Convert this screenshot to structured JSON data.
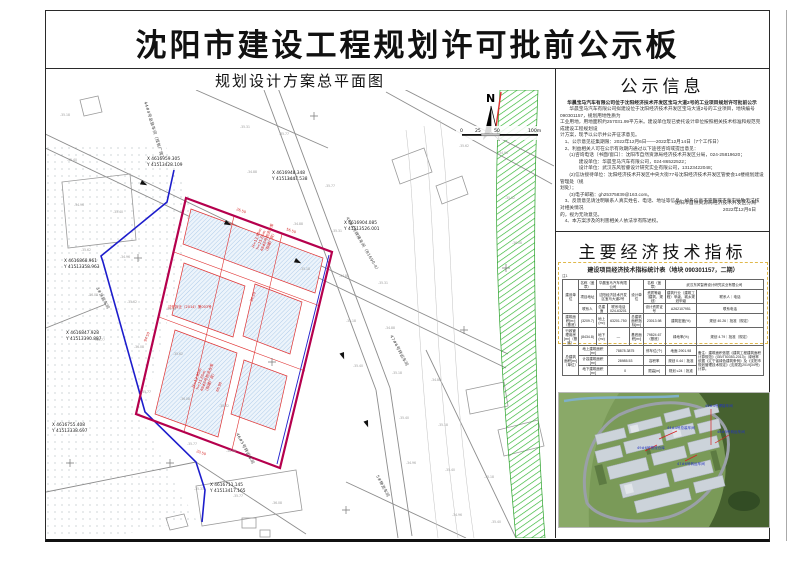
{
  "title": "沈阳市建设工程规划许可批前公示板",
  "map": {
    "title": "规划设计方案总平面图",
    "north": "N",
    "scale_ticks": [
      "0",
      "25",
      "50",
      "100m"
    ],
    "coords": [
      {
        "x": "X 4616959.305",
        "y": "Y 41513428.109"
      },
      {
        "x": "X 4616948.348",
        "y": "Y 41513447.538"
      },
      {
        "x": "X 4616904.085",
        "y": "Y 41513526.001"
      },
      {
        "x": "X 4616868.961",
        "y": "Y 41513358.963"
      },
      {
        "x": "X 4616847.928",
        "y": "Y 41513390.887"
      },
      {
        "x": "X 4616755.408",
        "y": "Y 41513338.697"
      },
      {
        "x": "X 4616711.145",
        "y": "Y 41513417.165"
      }
    ],
    "road_labels": [
      "44#4号总装车间（现有厂房）",
      "46#4号焊接车间（B1690-4）",
      "47#6号转运车间",
      "46#5号转运车间",
      "3#涂装车间",
      "5#物流车间"
    ],
    "red_stack_1": [
      "H=13.85m",
      "h=15.65m",
      "49#6号物流仓库",
      "（拟建厂房）"
    ],
    "red_stack_2": [
      "H=13.85m",
      "h=15.65m",
      "48#6号物流仓库",
      "（拟建厂房）"
    ],
    "red_dims": [
      "26.50",
      "56.50",
      "94.50",
      "20.50",
      "34.20",
      "66.98"
    ],
    "demolition_note": "沈开拆迁（2014）第003号",
    "elevation_samples": [
      "-35.18",
      "-35.40",
      "-34.96",
      "-35.62",
      "-36.08",
      "-35.77",
      "-35.31",
      "-34.88"
    ]
  },
  "notice": {
    "title": "公示信息",
    "heading": "华晨宝马汽车有限公司位于沈阳经济技术开发区宝马大道2号的工业项目规划许可批前公示",
    "lines": [
      "　　华晨宝马汽车有限公司拟建设位于沈阳经济技术开发区宝马大道2号的工业项目，地块编号090301157，规划用地性质为",
      "工业用地，用地面积约257031.99平方米。建设单位现已委托设计单位按照相关技术标准和规范完成建设工程规划设",
      "计方案，现予以公示并公开征求意见。",
      "　1、公示意见征集期限：2022年12月6日——2022年12月14日（7个工作日）",
      "　2、利益相关人可在公示有效期内通过以下途径咨询或提出意见：",
      "　　(1)咨询电话（书面/窗口）：沈阳市自然资源局经济技术开发区分局，024-25819620；",
      "　　　　建设单位：华晨宝马汽车有限公司，024-86522522；",
      "　　　　设计单位：武汉东风智睿设计研究实业有限公司，13123422048；",
      "　　(2)信访接待单位：沈阳经济技术开发区中央大街77号沈阳经济技术开发区管委会14楼规划建设管理处（规",
      "划处）；",
      "　　(3)电子邮箱：gh25375839@163.com。",
      "　3、反馈意见请注明联系人真实姓名、电话、地址等信息；如各信息不完整或不真实导致无法核对相关情况",
      "的，视为无效意见。",
      "　4、本方案涉及的利害相关人依法享有陈述权。"
    ],
    "signature": [
      "沈阳市自然资源局经济技术开发区分局",
      "2022年12月6日"
    ]
  },
  "indicators": {
    "title": "主要经济技术指标",
    "caption": "建设项目经济技术指标统计表（地块 090301157，二期）",
    "note": "注1",
    "table": {
      "rows": [
        [
          {
            "t": "建设单位",
            "r": 3
          },
          {
            "t": "名称（盖章）"
          },
          {
            "t": "华晨宝马汽车有限公司",
            "c": 2
          },
          {
            "t": "设计单位",
            "r": 3
          },
          {
            "t": "名称（盖章）"
          },
          {
            "t": "武汉东风智睿设计研究实业有限公司",
            "c": 3
          }
        ],
        [
          {
            "t": "项目地址"
          },
          {
            "t": "沈阳经济技术开发区宝马大道2号",
            "c": 2
          },
          {
            "t": "资质等级（建筑、规划）"
          },
          {
            "t": "建筑行业（建筑工程）甲级、城乡规划甲级",
            "c": 2
          },
          {
            "t": "联系人｜电话"
          }
        ],
        [
          {
            "t": "联系人"
          },
          {
            "t": "总建面"
          },
          {
            "t": "联系电话 024-63201"
          },
          {
            "t": "设计资质证号"
          },
          {
            "t": "A262107951"
          },
          {
            "t": "联系电话",
            "c": 2
          }
        ],
        [
          {
            "t": "建筑面积[m²]（基底）"
          },
          {
            "t": "(3209.7)"
          },
          {
            "t": "地上(m²)"
          },
          {
            "t": "63201.750"
          },
          {
            "t": "总建筑面积指标[m²]"
          },
          {
            "t": "23013.98"
          },
          {
            "t": "建筑密度(%)"
          },
          {
            "t": "规划 40.26｜批准（规定）",
            "c": 2
          }
        ],
        [
          {
            "t": "行政管理用房[m²]（基底）"
          },
          {
            "t": "(8434.8)"
          },
          {
            "t": "地下(m²)"
          },
          {
            "t": "—"
          },
          {
            "t": "基底面积[m²]"
          },
          {
            "t": "79824.67（基底）"
          },
          {
            "t": "绿地率(%)"
          },
          {
            "t": "规划 4.79｜批准（规定）",
            "c": 2
          }
        ],
        [
          {
            "t": "总建筑面积[m²]（单位）",
            "r": 3
          },
          {
            "t": "地上建筑面积[m²]",
            "c": 2
          },
          {
            "t": "78878.3875",
            "c": 2
          },
          {
            "t": "停车位(个)"
          },
          {
            "t": "地面 2901.98"
          },
          {
            "t": "备注：建筑面积依据《建筑工程建筑面积计算规范》(GB/T50353-2013)；绿地率依据《辽宁省绿色建筑条例》及《沈阳市规划管理技术规定》(沈规发[2019]34号) 计算。",
            "r": 3,
            "c": 2,
            "cls": "rem"
          }
        ],
        [
          {
            "t": "计容建筑面积[m²]",
            "c": 2
          },
          {
            "t": "28985.53",
            "c": 2
          },
          {
            "t": "容积率"
          },
          {
            "t": "规划 0.44｜批准"
          }
        ],
        [
          {
            "t": "地下建筑面积[m²]",
            "c": 2
          },
          {
            "t": "0",
            "c": 2
          },
          {
            "t": "限高[m]"
          },
          {
            "t": "规划 ≤24｜批准"
          }
        ]
      ]
    }
  },
  "render": {
    "annotations": [
      "46#4号焊接车间",
      "44#4号总装车间",
      "49#6号物流仓库",
      "47#6号转运车间",
      "46#5号转运车间"
    ]
  }
}
